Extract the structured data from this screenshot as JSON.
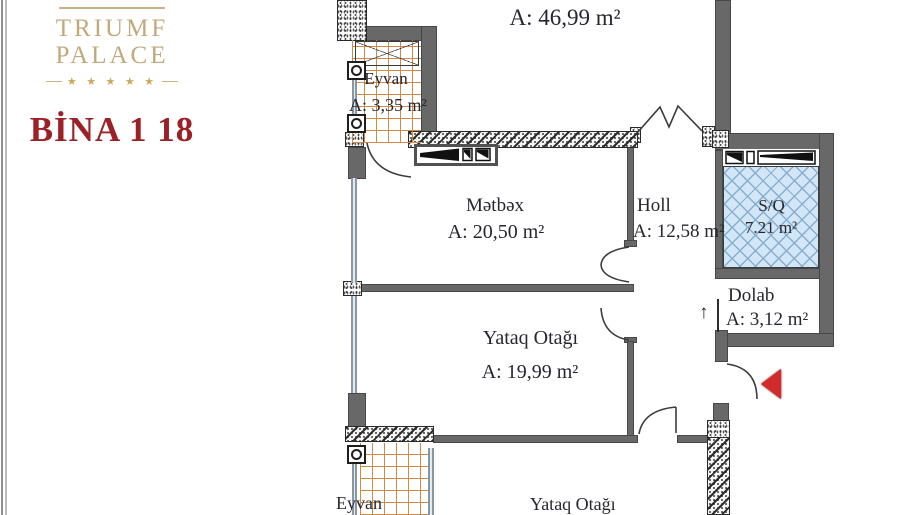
{
  "brand": {
    "line1": "TRIUMF",
    "line2": "PALACE",
    "stars": "★ ★ ★ ★ ★",
    "building": "BİNA 1 18"
  },
  "rooms": {
    "living": {
      "area_label": "A: 46,99 m²"
    },
    "eyvan_top": {
      "name": "Eyvan",
      "area_label": "A: 3,35 m²"
    },
    "metbex": {
      "name": "Mətbəx",
      "area_label": "A: 20,50 m²"
    },
    "holl": {
      "name": "Holl",
      "area_label": "A: 12,58 m²"
    },
    "sq": {
      "name": "S/Q",
      "area_label": "7.21 m²"
    },
    "dolab": {
      "name": "Dolab",
      "area_label": "A: 3,12 m²"
    },
    "yataq1": {
      "name": "Yataq Otağı",
      "area_label": "A: 19,99 m²"
    },
    "eyvan_bottom": {
      "name": "Eyvan"
    },
    "yataq2": {
      "name": "Yataq Otağı"
    }
  },
  "symbols": {
    "dolab_direction_arrow": "↑",
    "entrance_pointer_icon": "red-triangle-left"
  },
  "colors": {
    "brand_gold": "#c2a97c",
    "brand_red": "#9c2127",
    "wall_grey": "#686868",
    "tile_orange": "#cf8a45",
    "wet_area_blue": "#d3e6f6",
    "entrance_red": "#cf2b28"
  }
}
